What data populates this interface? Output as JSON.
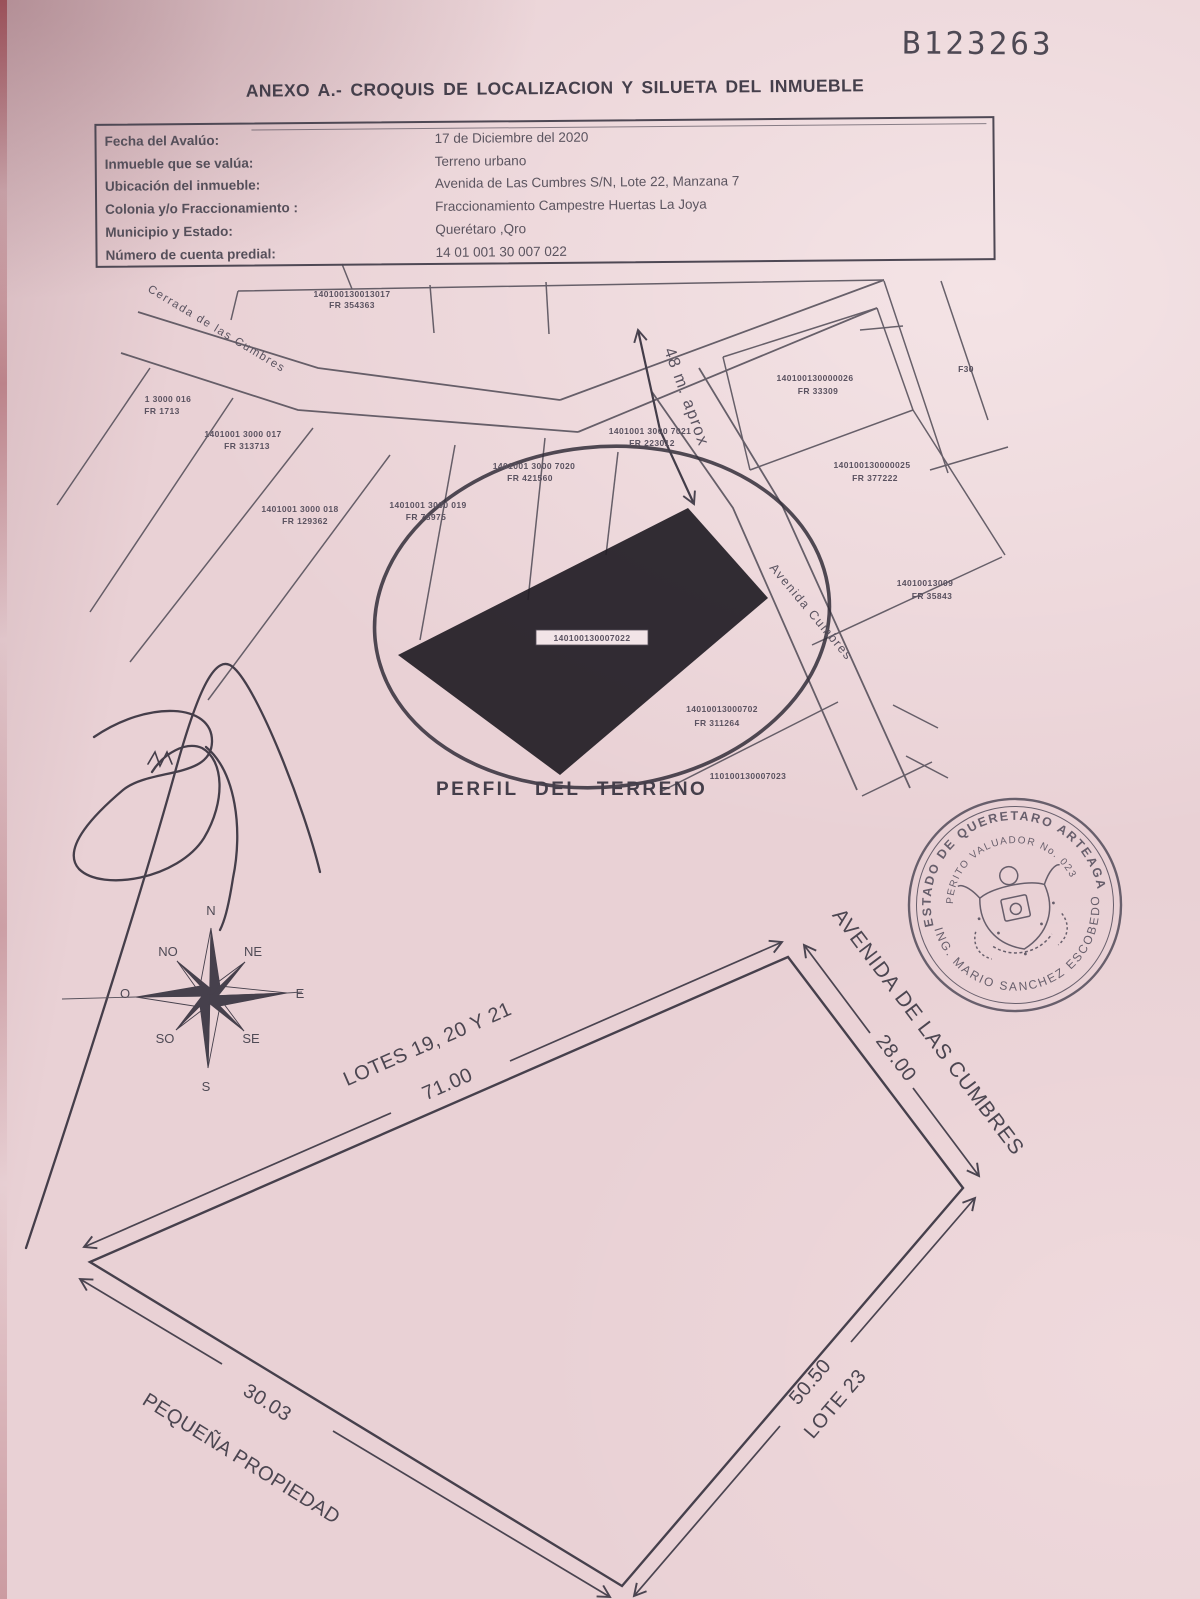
{
  "colors": {
    "paper": "#e9d1d5",
    "ink": "#4a4450"
  },
  "page": {
    "booklet_number": "B123263",
    "title": "ANEXO A.- CROQUIS DE LOCALIZACION Y SILUETA DEL INMUEBLE"
  },
  "info_table": {
    "rows": [
      {
        "label": "Fecha del Avalúo:",
        "value": "17 de Diciembre del 2020"
      },
      {
        "label": "Inmueble que se valúa:",
        "value": "Terreno urbano"
      },
      {
        "label": "Ubicación del inmueble:",
        "value": "Avenida de Las Cumbres S/N, Lote 22, Manzana 7"
      },
      {
        "label": "Colonia y/o Fraccionamiento :",
        "value": "Fraccionamiento Campestre Huertas La Joya"
      },
      {
        "label": "Municipio y Estado:",
        "value": "Querétaro ,Qro"
      },
      {
        "label": "Número de cuenta predial:",
        "value": "14 01 001 30 007 022"
      }
    ]
  },
  "map": {
    "street_cerrada": "Cerrada de las Cumbres",
    "street_avenida": "Avenida Cumbres",
    "distance_note": "48 m. aprox",
    "subject_parcel_id": "140100130007022",
    "caption": "PERFIL DEL TERRENO",
    "parcels": [
      {
        "l1": "140100130013017",
        "l2": "FR 354363"
      },
      {
        "l1": "1 3000 016",
        "l2": "FR 1713"
      },
      {
        "l1": "1401001 3000 017",
        "l2": "FR 313713"
      },
      {
        "l1": "1401001 3000 018",
        "l2": "FR 129362"
      },
      {
        "l1": "1401001 3000 019",
        "l2": "FR 78975"
      },
      {
        "l1": "1401001 3000 7020",
        "l2": "FR 421560"
      },
      {
        "l1": "1401001 3000 7021",
        "l2": "FR 223012"
      },
      {
        "l1": "140100130000026",
        "l2": "FR 33309"
      },
      {
        "l1": "140100130000025",
        "l2": "FR 377222"
      },
      {
        "l1": "14010013009",
        "l2": "FR 35843"
      },
      {
        "l1": "14010013000702",
        "l2": "FR 311264"
      },
      {
        "l1": "110100130007023",
        "l2": ""
      },
      {
        "l1": "F30",
        "l2": ""
      }
    ]
  },
  "compass": {
    "n": "N",
    "ne": "NE",
    "e": "E",
    "se": "SE",
    "s": "S",
    "so": "SO",
    "o": "O",
    "no": "NO"
  },
  "seal": {
    "arc_top": "ESTADO DE QUERETARO ARTEAGA",
    "arc_middle": "PERITO VALUADOR No. 023",
    "arc_bottom": "ING. MARIO SANCHEZ ESCOBEDO"
  },
  "silhouette": {
    "edge_top_name": "LOTES 19, 20 Y 21",
    "edge_top_dim": "71.00",
    "edge_right_name": "AVENIDA DE LAS CUMBRES",
    "edge_right_dim": "28.00",
    "edge_bottomright_name": "LOTE 23",
    "edge_bottomright_dim": "50.50",
    "edge_bottomleft_name": "PEQUEÑA PROPIEDAD",
    "edge_bottomleft_dim": "30.03"
  }
}
